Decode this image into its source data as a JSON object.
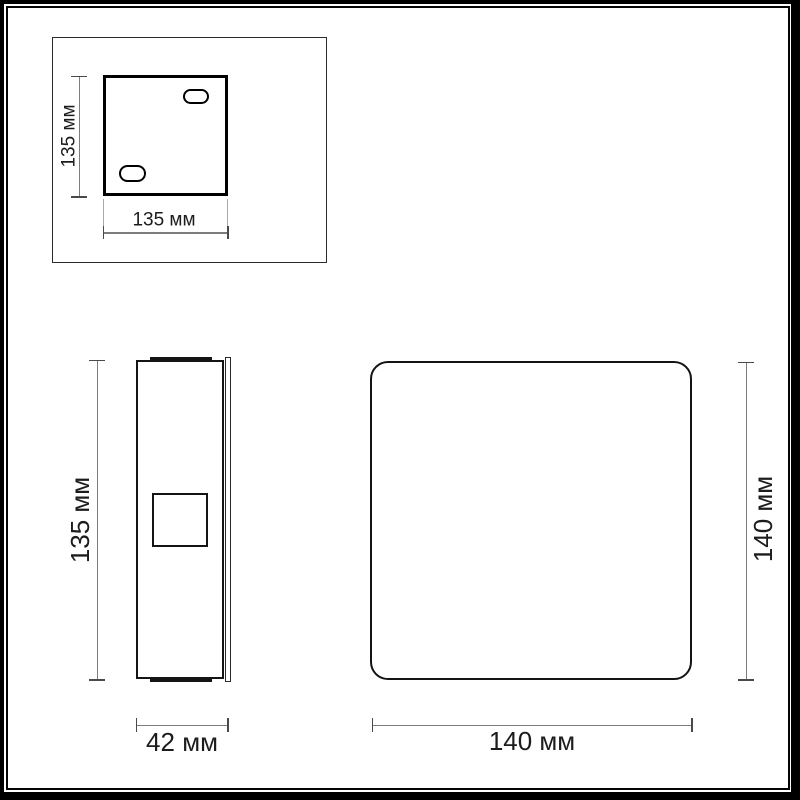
{
  "title": "Wall lamp dimension drawing",
  "units": "мм",
  "views": {
    "mounting_plate": {
      "name": "mounting plate detail (back view)",
      "height_label": "135 мм",
      "width_label": "135 мм"
    },
    "side": {
      "name": "side profile view",
      "height_label": "135 мм",
      "depth_label": "42 мм"
    },
    "front": {
      "name": "front view",
      "height_label": "140 мм",
      "width_label": "140 мм"
    }
  },
  "colors": {
    "outline": "#141414",
    "dimension_line": "#7d7d7d",
    "dimension_tick": "#4a4a4a",
    "text": "#1c1c1c",
    "background": "#ffffff",
    "frame": "#000000"
  }
}
